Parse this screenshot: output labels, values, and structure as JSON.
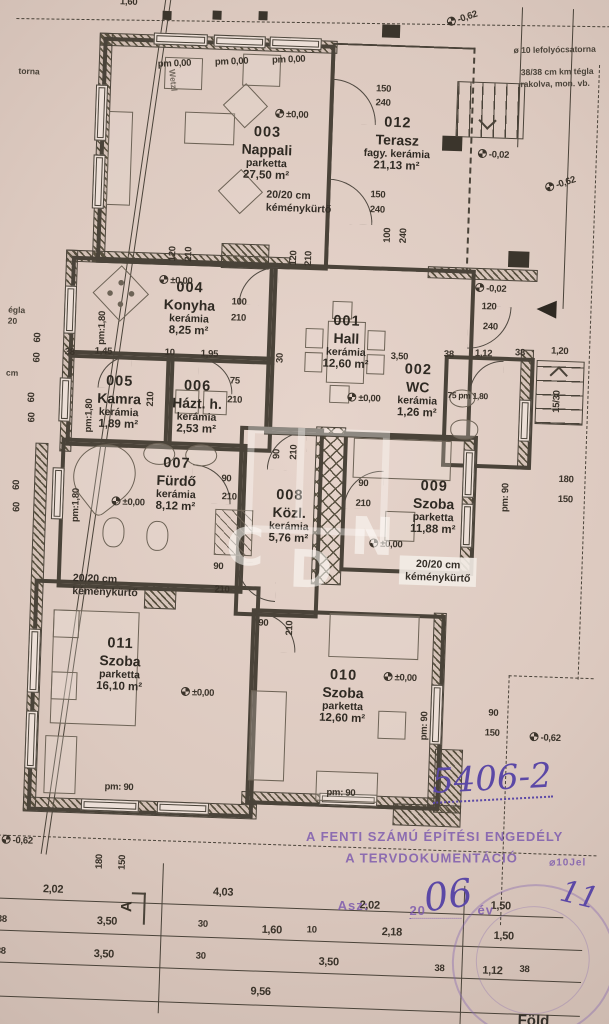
{
  "rooms": [
    {
      "number": "001",
      "name": "Hall",
      "material": "kerámia",
      "area": "12,60 m²"
    },
    {
      "number": "002",
      "name": "WC",
      "material": "kerámia",
      "area": "1,26 m²"
    },
    {
      "number": "003",
      "name": "Nappali",
      "material": "parketta",
      "area": "27,50 m²"
    },
    {
      "number": "004",
      "name": "Konyha",
      "material": "kerámia",
      "area": "8,25 m²"
    },
    {
      "number": "005",
      "name": "Kamra",
      "material": "kerámia",
      "area": "1,89 m²"
    },
    {
      "number": "006",
      "name": "Házt. h.",
      "material": "kerámia",
      "area": "2,53 m²"
    },
    {
      "number": "007",
      "name": "Fürdő",
      "material": "kerámia",
      "area": "8,12 m²"
    },
    {
      "number": "008",
      "name": "Közl.",
      "material": "kerámia",
      "area": "5,76 m²"
    },
    {
      "number": "009",
      "name": "Szoba",
      "material": "parketta",
      "area": "11,88 m²"
    },
    {
      "number": "010",
      "name": "Szoba",
      "material": "parketta",
      "area": "12,60 m²"
    },
    {
      "number": "011",
      "name": "Szoba",
      "material": "parketta",
      "area": "16,10 m²"
    },
    {
      "number": "012",
      "name": "Terasz",
      "material": "fagy. kerámia",
      "area": "21,13 m²"
    }
  ],
  "chimney": {
    "line1": "20/20 cm",
    "line2": "kéménykürtő"
  },
  "notes": {
    "drain": "ø 10 lefolyócsatorna",
    "brick1": "38/38 cm km tégla",
    "brick2": "rakolva, mon. vb.",
    "edge1": "égla",
    "edge2": "20",
    "edge3": "cm",
    "boundary": "torna",
    "street": "Wetzl"
  },
  "stamp": {
    "line1": "A FENTI SZÁMÚ ÉPÍTÉSI ENGEDÉLY",
    "line2": "A TERVDOKUMENTÁCIÓ",
    "tail": "⌀10Jel",
    "asz": "Asz:",
    "d20": "20",
    "ev": "év"
  },
  "handwriting": {
    "number": "5406-2",
    "year": "06",
    "mark": "11",
    "bottom": "Föld"
  },
  "section_marker": "A",
  "watermark": {
    "c": "C",
    "d": "D",
    "n": "N"
  },
  "dims": [
    "1,60",
    "-0,62",
    "pm 0,00",
    "pm 0,00",
    "pm 0,00",
    "±0,00",
    "150",
    "240",
    "150",
    "240",
    "100",
    "240",
    "-0,02",
    "-0,62",
    "120",
    "210",
    "120",
    "210",
    "±0,00",
    "100",
    "210",
    "38",
    "1,45",
    "10",
    "1,95",
    "30",
    "pm:1,80",
    "pm:1,80",
    "75",
    "210",
    "210",
    "3,50",
    "±0,00",
    "75 pm 1,80",
    "-0,02",
    "120",
    "240",
    "1,12",
    "38",
    "38",
    "1,20",
    "15/30",
    "pm:1,80",
    "±0,00",
    "90",
    "210",
    "90",
    "210",
    "90",
    "210",
    "90",
    "210",
    "±0,00",
    "pm: 90",
    "180",
    "150",
    "±0,00",
    "pm: 90",
    "60",
    "60",
    "60",
    "60",
    "60",
    "60",
    "-0,62",
    "180",
    "150",
    "±0,00",
    "pm: 90",
    "pm: 90",
    "90",
    "210",
    "90",
    "150",
    "-0,62",
    "2,02",
    "4,03",
    "2,02",
    "1,50",
    "38",
    "3,50",
    "30",
    "1,60",
    "10",
    "2,18",
    "1,50",
    "38",
    "3,50",
    "30",
    "3,50",
    "38",
    "1,12",
    "38",
    "9,56"
  ]
}
